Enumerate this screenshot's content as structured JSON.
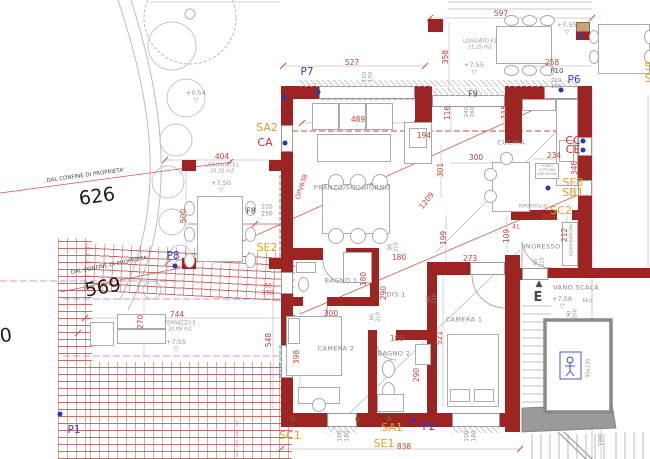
{
  "title": "Pianta appartamento - disegno CAD",
  "colors": {
    "wall": "#9c2423",
    "dimension_text": "#c7433c",
    "point_label": "#3340c8",
    "fixture_label": "#e59a33",
    "category_label": "#d03028",
    "tile_hatch": "#ba564e",
    "terrace_dash": "#d892d8",
    "glass_dash": "#58c8c8",
    "furniture_line": "#ababab"
  },
  "labels": [
    {
      "t": "597",
      "x": 501,
      "y": 14
    },
    {
      "t": "527",
      "x": 352,
      "y": 63
    },
    {
      "t": "489",
      "x": 358,
      "y": 120
    },
    {
      "t": "404",
      "x": 222,
      "y": 157
    },
    {
      "t": "258",
      "x": 552,
      "y": 63
    },
    {
      "t": "234",
      "x": 554,
      "y": 156
    },
    {
      "t": "300",
      "x": 476,
      "y": 158
    },
    {
      "t": "194",
      "x": 424,
      "y": 136
    },
    {
      "t": "744",
      "x": 177,
      "y": 315
    },
    {
      "t": "273",
      "x": 470,
      "y": 259
    },
    {
      "t": "203",
      "x": 549,
      "y": 218
    },
    {
      "t": "41",
      "x": 516,
      "y": 228,
      "s": 6
    },
    {
      "t": "838",
      "x": 404,
      "y": 447
    },
    {
      "t": "180",
      "x": 399,
      "y": 258
    },
    {
      "t": "300",
      "x": 331,
      "y": 314
    },
    {
      "t": "180",
      "x": 397,
      "y": 339
    },
    {
      "t": "1209",
      "x": 427,
      "y": 201,
      "r": -52
    },
    {
      "t": "OPV638",
      "x": 302,
      "y": 187,
      "r": -72,
      "s": 6.5
    },
    {
      "t": "500",
      "x": 184,
      "y": 216,
      "r": -90
    },
    {
      "t": "358",
      "x": 446,
      "y": 57,
      "r": -90
    },
    {
      "t": "346",
      "x": 575,
      "y": 168,
      "r": -90
    },
    {
      "t": "301",
      "x": 441,
      "y": 170,
      "r": -90
    },
    {
      "t": "270",
      "x": 141,
      "y": 322,
      "r": -90
    },
    {
      "t": "548",
      "x": 269,
      "y": 340,
      "r": -90
    },
    {
      "t": "398",
      "x": 297,
      "y": 357,
      "r": -90
    },
    {
      "t": "290",
      "x": 384,
      "y": 293,
      "r": -90
    },
    {
      "t": "180",
      "x": 364,
      "y": 279,
      "r": -90
    },
    {
      "t": "290",
      "x": 417,
      "y": 375,
      "r": -90
    },
    {
      "t": "521",
      "x": 440,
      "y": 338,
      "r": -90
    },
    {
      "t": "199",
      "x": 444,
      "y": 238,
      "r": -90
    },
    {
      "t": "109",
      "x": 507,
      "y": 236,
      "r": -90
    },
    {
      "t": "212",
      "x": 565,
      "y": 235,
      "r": -90
    },
    {
      "t": "116",
      "x": 448,
      "y": 113,
      "r": -90
    },
    {
      "t": "115",
      "x": 505,
      "y": 112,
      "r": -90
    },
    {
      "t": "100",
      "x": 601,
      "y": 440,
      "r": -90,
      "c": "gray"
    },
    {
      "t": "60\n150",
      "x": 268,
      "y": 290,
      "s": 6
    },
    {
      "t": "100\n180",
      "x": 344,
      "y": 436,
      "r": -90,
      "c": "gray",
      "s": 6
    },
    {
      "t": "100\n180",
      "x": 471,
      "y": 436,
      "r": -90,
      "c": "gray",
      "s": 6
    },
    {
      "t": "210\n250",
      "x": 267,
      "y": 211,
      "c": "gray",
      "s": 6
    },
    {
      "t": "210\n150",
      "x": 556,
      "y": 84,
      "c": "gray",
      "s": 5.5
    },
    {
      "t": "240\n260",
      "x": 470,
      "y": 112,
      "r": -90,
      "c": "gray",
      "s": 5.5
    },
    {
      "t": "120\n150",
      "x": 368,
      "y": 77,
      "r": -90,
      "c": "gray",
      "s": 5.5
    },
    {
      "t": "80\n210",
      "x": 394,
      "y": 247,
      "r": -90,
      "c": "gray",
      "s": 5
    },
    {
      "t": "80\n210",
      "x": 376,
      "y": 317,
      "r": -90,
      "c": "gray",
      "s": 5
    },
    {
      "t": "80\n210",
      "x": 432,
      "y": 299,
      "r": -90,
      "c": "gray",
      "s": 5
    },
    {
      "t": "90\n210",
      "x": 540,
      "y": 262,
      "r": -90,
      "c": "gray",
      "s": 5
    },
    {
      "t": "90\n200",
      "x": 573,
      "y": 314,
      "r": -90,
      "c": "gray",
      "s": 5
    },
    {
      "t": "+0.54\n▽",
      "x": 196,
      "y": 97,
      "c": "gray"
    },
    {
      "t": "+7.50\n▽",
      "x": 221,
      "y": 187,
      "c": "gray"
    },
    {
      "t": "+7.55\n▽",
      "x": 474,
      "y": 69,
      "c": "gray"
    },
    {
      "t": "+7.55\n▽",
      "x": 567,
      "y": 29,
      "c": "gray"
    },
    {
      "t": "+7.55\n▽",
      "x": 176,
      "y": 346,
      "c": "gray"
    },
    {
      "t": "+7.58\n▽",
      "x": 562,
      "y": 303,
      "c": "gray"
    },
    {
      "t": "H=",
      "x": 588,
      "y": 301,
      "c": "gray"
    },
    {
      "t": "LOGGIATO  E1\n20.20  m2",
      "x": 222,
      "y": 169,
      "c": "tiny"
    },
    {
      "t": "LOGGIATO  E2\n21.25  m2",
      "x": 480,
      "y": 45,
      "c": "tiny"
    },
    {
      "t": "TERRAZZO  E\n20.09  m2",
      "x": 180,
      "y": 327,
      "c": "tiny"
    },
    {
      "t": "PRANZO/SOGGIORNO",
      "x": 352,
      "y": 188,
      "c": "room"
    },
    {
      "t": "CUCINA",
      "x": 511,
      "y": 143,
      "c": "room"
    },
    {
      "t": "BAGNO  1",
      "x": 341,
      "y": 281,
      "c": "room"
    },
    {
      "t": "DIS  1",
      "x": 396,
      "y": 295,
      "c": "room"
    },
    {
      "t": "CAMERA  2",
      "x": 336,
      "y": 349,
      "c": "room"
    },
    {
      "t": "BAGNO  2",
      "x": 394,
      "y": 354,
      "c": "room"
    },
    {
      "t": "CAMERA  1",
      "x": 464,
      "y": 320,
      "c": "room"
    },
    {
      "t": "INGRESSO",
      "x": 542,
      "y": 247,
      "c": "room"
    },
    {
      "t": "RIPOSTIGLIO",
      "x": 533,
      "y": 208,
      "c": "tiny",
      "s": 4.5
    },
    {
      "t": "GUARDAROBA",
      "x": 573,
      "y": 240,
      "r": -90,
      "c": "tiny",
      "s": 4.5
    },
    {
      "t": "VANO  SCALA",
      "x": 576,
      "y": 288,
      "c": "room"
    },
    {
      "t": "F8",
      "x": 251,
      "y": 212,
      "c": "blk",
      "s": 8
    },
    {
      "t": "F9",
      "x": 473,
      "y": 95,
      "c": "blk",
      "s": 8
    },
    {
      "t": "F10",
      "x": 557,
      "y": 72,
      "c": "blk",
      "s": 7
    },
    {
      "t": ". DAL CONFINE DI PROPRIETA'",
      "x": 84,
      "y": 176,
      "r": -8,
      "c": "blk",
      "s": 5.5
    },
    {
      "t": ". DAL CONFINE DI PROPRIETA'",
      "x": 108,
      "y": 266,
      "r": -11,
      "c": "blk",
      "s": 5.5
    },
    {
      "t": "626",
      "x": 97,
      "y": 197,
      "r": -8,
      "c": "big"
    },
    {
      "t": "569",
      "x": 103,
      "y": 288,
      "r": -10,
      "c": "big"
    },
    {
      "t": "50",
      "x": 0,
      "y": 337,
      "r": -8,
      "c": "big"
    },
    {
      "t": "SA2",
      "x": 267,
      "y": 128,
      "c": "or"
    },
    {
      "t": "SE2",
      "x": 267,
      "y": 248,
      "c": "or"
    },
    {
      "t": "SC1",
      "x": 290,
      "y": 436,
      "c": "or"
    },
    {
      "t": "SA1",
      "x": 392,
      "y": 428,
      "c": "or"
    },
    {
      "t": "SE1",
      "x": 384,
      "y": 444,
      "c": "or"
    },
    {
      "t": "SE3",
      "x": 573,
      "y": 183,
      "c": "or"
    },
    {
      "t": "SB1",
      "x": 573,
      "y": 193,
      "c": "or"
    },
    {
      "t": "SC2",
      "x": 561,
      "y": 211,
      "c": "or"
    },
    {
      "t": "S",
      "x": 648,
      "y": 67,
      "c": "or"
    },
    {
      "t": "S",
      "x": 648,
      "y": 79,
      "c": "or"
    },
    {
      "t": "CA",
      "x": 265,
      "y": 143,
      "c": "rl"
    },
    {
      "t": "CC",
      "x": 573,
      "y": 141,
      "c": "rl"
    },
    {
      "t": "CE",
      "x": 573,
      "y": 150,
      "c": "rl"
    },
    {
      "t": "P7",
      "x": 307,
      "y": 73,
      "c": "bl"
    },
    {
      "t": "P6",
      "x": 574,
      "y": 81,
      "c": "bl"
    },
    {
      "t": "P8",
      "x": 173,
      "y": 257,
      "c": "bl"
    },
    {
      "t": "P1",
      "x": 74,
      "y": 431,
      "c": "bl"
    },
    {
      "t": "P2",
      "x": 429,
      "y": 428,
      "c": "bl"
    },
    {
      "t": "▲",
      "x": 539,
      "y": 285,
      "c": "blk",
      "s": 9
    },
    {
      "t": "E",
      "x": 538,
      "y": 298,
      "c": "blk",
      "s": 13,
      "b": 1
    },
    {
      "t": "95x130",
      "x": 589,
      "y": 368,
      "r": -90,
      "c": "tiny"
    },
    {
      "t": "FORNO\nCOTTURA\nINDUZIONE",
      "x": 547,
      "y": 171,
      "c": "tiny",
      "s": 3.5
    }
  ]
}
